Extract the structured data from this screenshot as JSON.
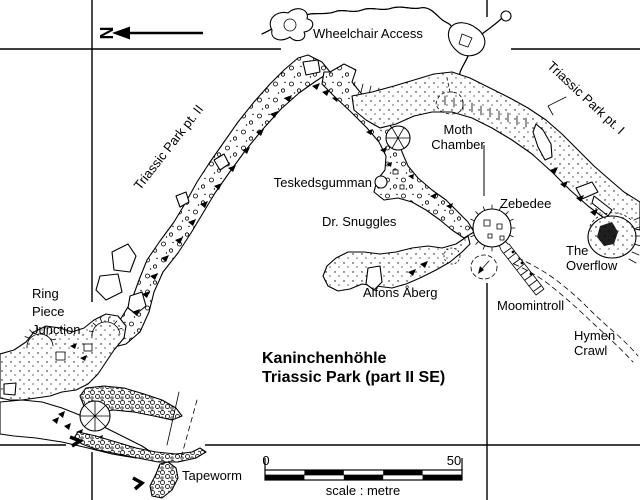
{
  "north_label": "N",
  "title": {
    "line1": "Kaninchenhöhle",
    "line2": "Triassic Park (part II SE)"
  },
  "labels": {
    "wheelchair": "Wheelchair Access",
    "tp2": "Triassic Park pt. II",
    "tp1": "Triassic Park pt. I",
    "moth1": "Moth",
    "moth2": "Chamber",
    "teskedsgumman": "Teskedsgumman",
    "snuggles": "Dr. Snuggles",
    "zebedee": "Zebedee",
    "overflow1": "The",
    "overflow2": "Overflow",
    "alfons": "Alfons Åberg",
    "moomintroll": "Moomintroll",
    "hymen1": "Hymen",
    "hymen2": "Crawl",
    "ring1": "Ring",
    "ring2": "Piece",
    "ring3": "Junction",
    "tapeworm": "Tapeworm"
  },
  "scale_bar": {
    "start": "0",
    "end": "50",
    "caption": "scale : metre"
  },
  "colors": {
    "ink": "#000000",
    "paper": "#ffffff"
  }
}
